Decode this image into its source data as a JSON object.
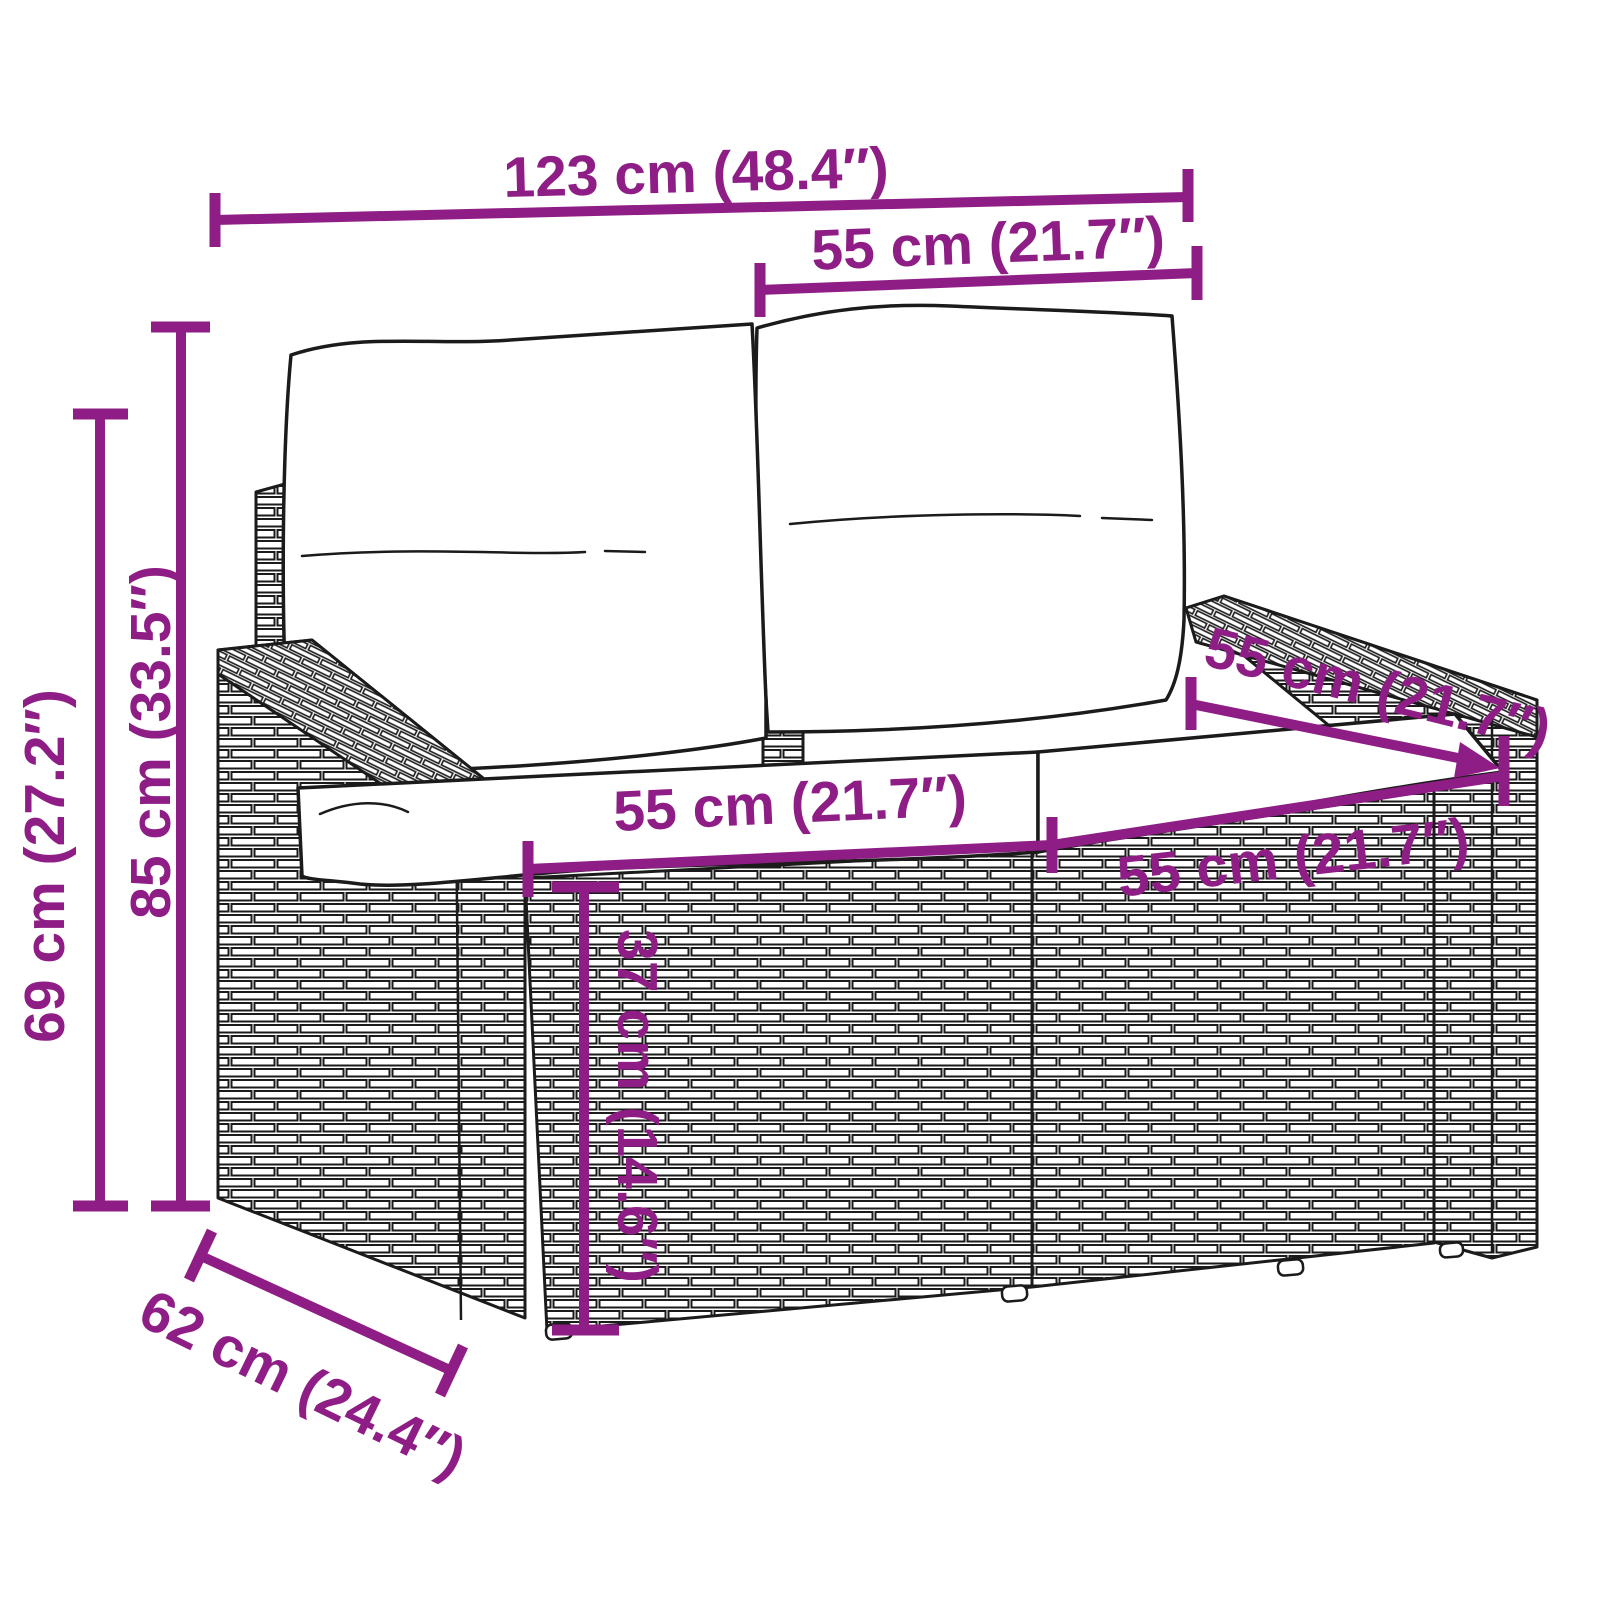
{
  "figure": {
    "description": "Technical dimension diagram: black line drawing of a two-seater poly rattan garden sofa with two back cushions and two seat cushions, annotated with purple dimension lines and ticks",
    "type": "product-dimension-diagram"
  },
  "colors": {
    "dimension_accent": "#8F1D86",
    "outline": "#1B1B1B",
    "background": "#FFFFFF"
  },
  "dims": {
    "overall_width": {
      "label": "123 cm (48.4″)"
    },
    "back_cushion_width": {
      "label": "55 cm (21.7″)"
    },
    "overall_height": {
      "label": "85 cm (33.5″)"
    },
    "armrest_height": {
      "label": "69 cm (27.2″)"
    },
    "seat_width_left": {
      "label": "55 cm (21.7″)"
    },
    "seat_width_right": {
      "label": "55 cm (21.7″)"
    },
    "seat_depth": {
      "label": "55 cm (21.7″)"
    },
    "seat_height": {
      "label": "37 cm (14.6″)"
    },
    "overall_depth": {
      "label": "62 cm (24.4″)"
    }
  }
}
